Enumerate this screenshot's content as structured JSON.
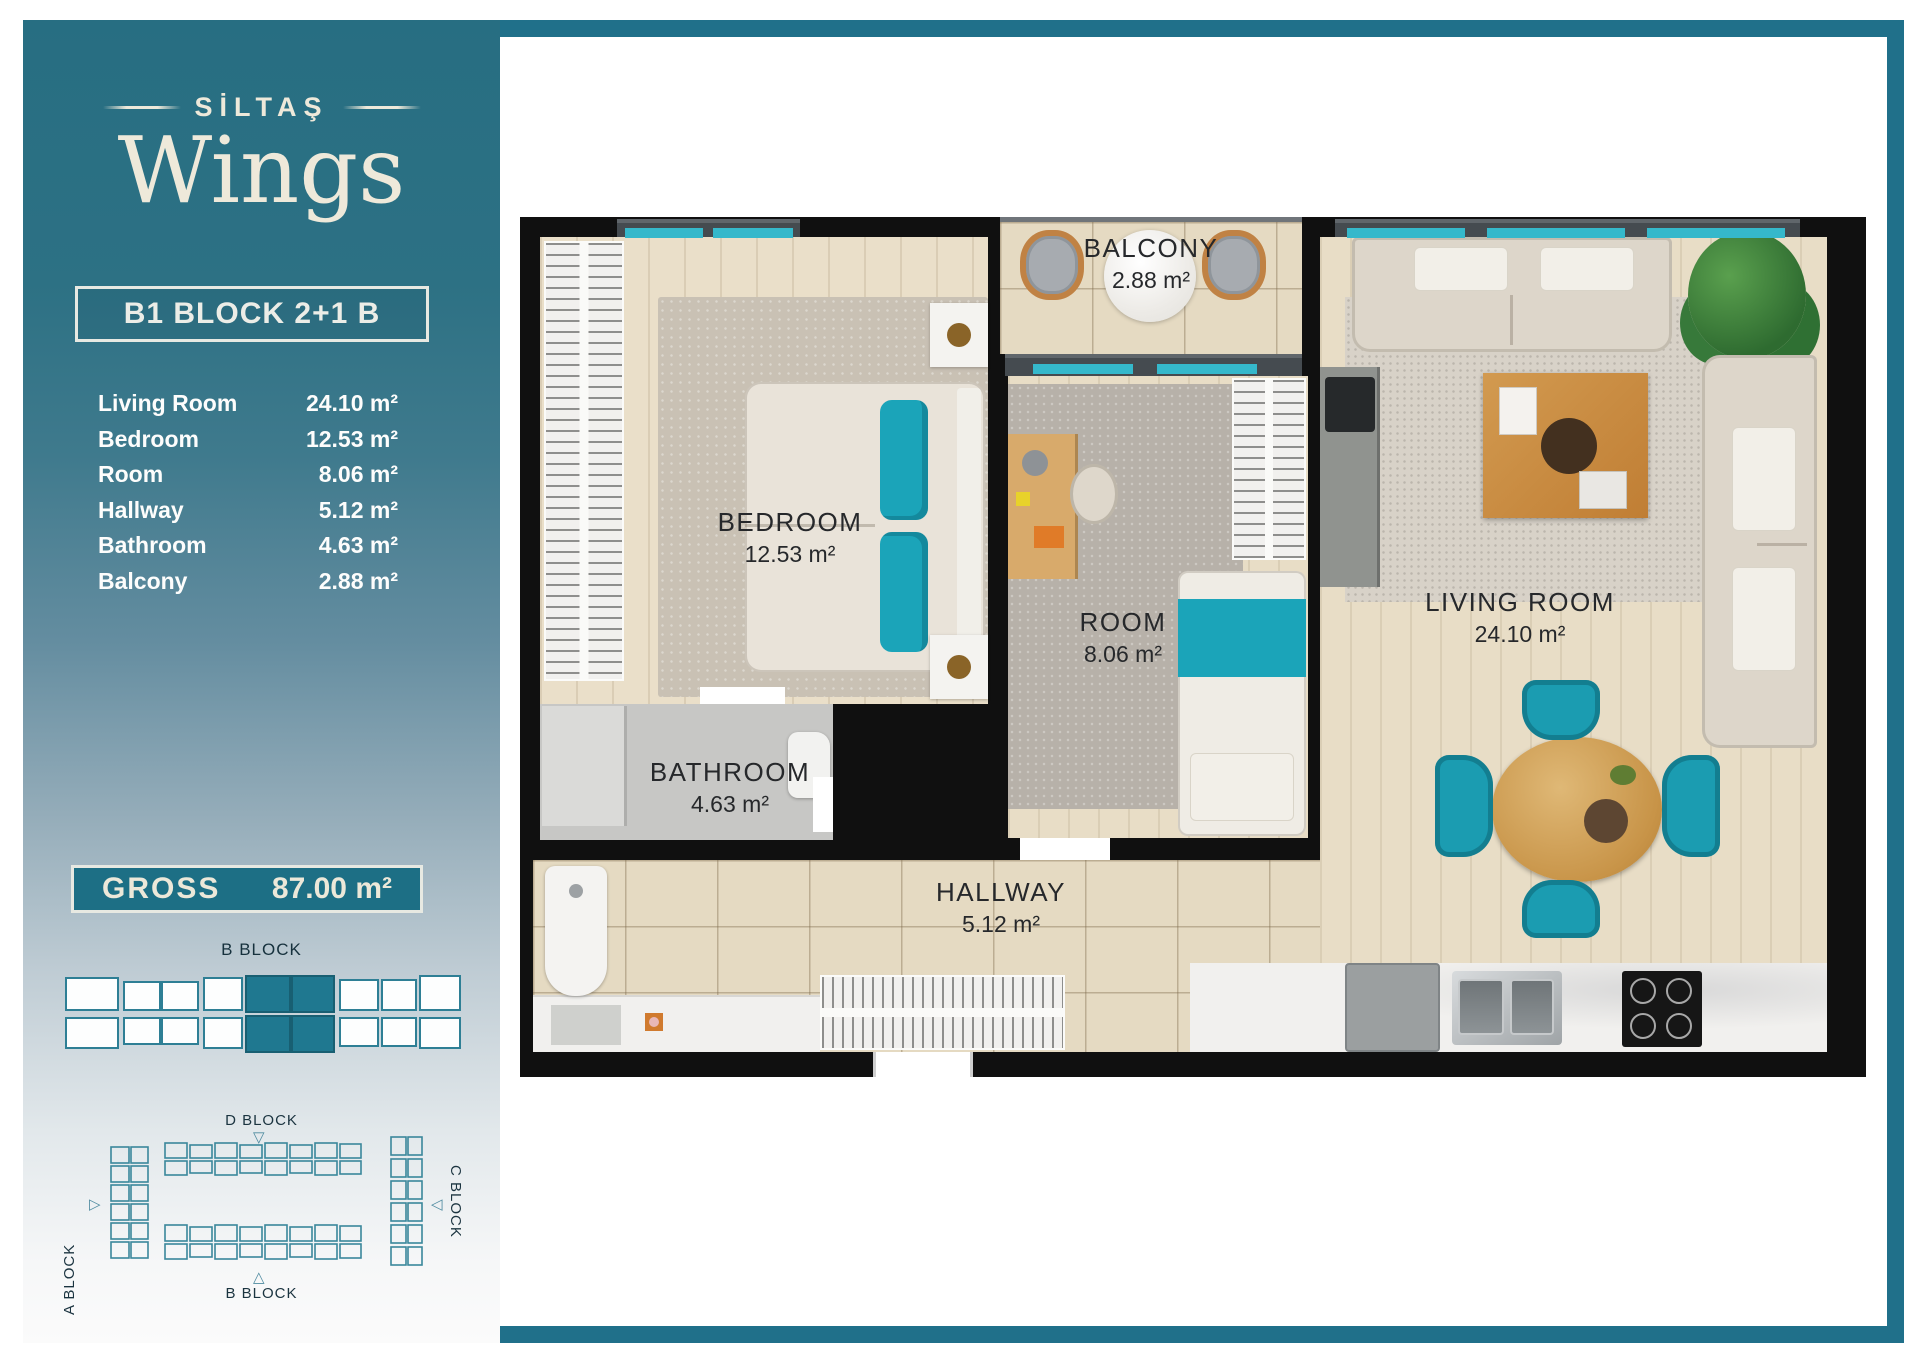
{
  "brand": {
    "top": "SİLTAŞ",
    "main": "Wings"
  },
  "unit": {
    "title": "B1 BLOCK 2+1 B"
  },
  "sidebar": {
    "rooms": [
      {
        "name": "Living Room",
        "area": "24.10 m²"
      },
      {
        "name": "Bedroom",
        "area": "12.53 m²"
      },
      {
        "name": "Room",
        "area": "8.06 m²"
      },
      {
        "name": "Hallway",
        "area": "5.12 m²"
      },
      {
        "name": "Bathroom",
        "area": "4.63 m²"
      },
      {
        "name": "Balcony",
        "area": "2.88 m²"
      }
    ],
    "gross": {
      "label": "GROSS",
      "value": "87.00 m²"
    },
    "block_diagram_label": "B BLOCK"
  },
  "site_plan": {
    "a": "A BLOCK",
    "b": "B BLOCK",
    "c": "C BLOCK",
    "d": "D BLOCK"
  },
  "plan": {
    "bedroom": {
      "name": "BEDROOM",
      "area": "12.53 m²"
    },
    "balcony": {
      "name": "BALCONY",
      "area": "2.88 m²"
    },
    "room": {
      "name": "ROOM",
      "area": "8.06 m²"
    },
    "living_room": {
      "name": "LIVING ROOM",
      "area": "24.10 m²"
    },
    "bathroom": {
      "name": "BATHROOM",
      "area": "4.63 m²"
    },
    "hallway": {
      "name": "HALLWAY",
      "area": "5.12 m²"
    }
  },
  "colors": {
    "accent_teal": "#20708a",
    "window_teal": "#35b8cb",
    "furniture_teal": "#1b9cb1",
    "wall_black": "#101010"
  }
}
